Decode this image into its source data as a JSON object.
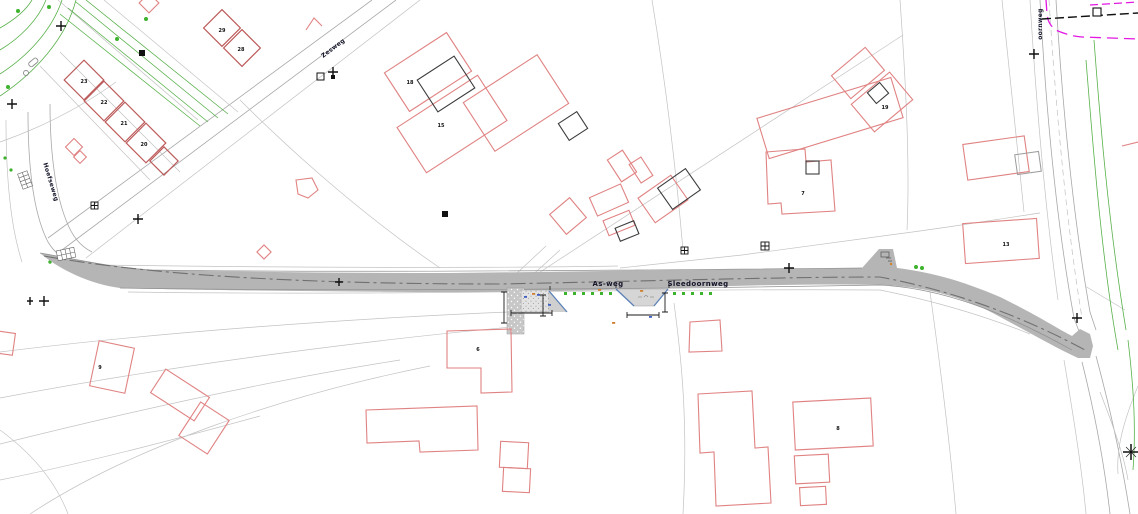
{
  "plan": {
    "type": "cad-site-plan",
    "background": "#ffffff",
    "street_labels": [
      {
        "id": "zesweg",
        "label": "Zesweg"
      },
      {
        "id": "hoefseweg",
        "label": "Hoefseweg"
      },
      {
        "id": "as-weg",
        "label": "As-weg"
      },
      {
        "id": "sleedoornweg",
        "label": "Sleedoornweg"
      },
      {
        "id": "oornweg",
        "label": "oornweg"
      }
    ],
    "building_numbers": [
      {
        "label": "23"
      },
      {
        "label": "22"
      },
      {
        "label": "21"
      },
      {
        "label": "20"
      },
      {
        "label": "29"
      },
      {
        "label": "28"
      },
      {
        "label": "18"
      },
      {
        "label": "15"
      },
      {
        "label": "7"
      },
      {
        "label": "19"
      },
      {
        "label": "13"
      },
      {
        "label": "6"
      },
      {
        "label": "8"
      },
      {
        "label": "9"
      }
    ],
    "symbols": [
      "survey-cross",
      "benchmark-star",
      "boundary-square-marker",
      "grid-marker",
      "hatched-crossing",
      "tree-dot",
      "hedge-line",
      "road-centerline",
      "dimension-line",
      "utility-line-magenta",
      "boundary-dashed-line"
    ],
    "colors": {
      "road_fill": "#b5b5b5",
      "road_centerline": "#707070",
      "building_outline_red": "#e08282",
      "building_outline_dark": "#3c3c3c",
      "parcel_line": "#c2c2c2",
      "vegetation_green": "#58b04a",
      "detail_blue": "#5b82b8",
      "utility_magenta": "#e218e2",
      "dimension_black": "#1a1a1a"
    }
  }
}
